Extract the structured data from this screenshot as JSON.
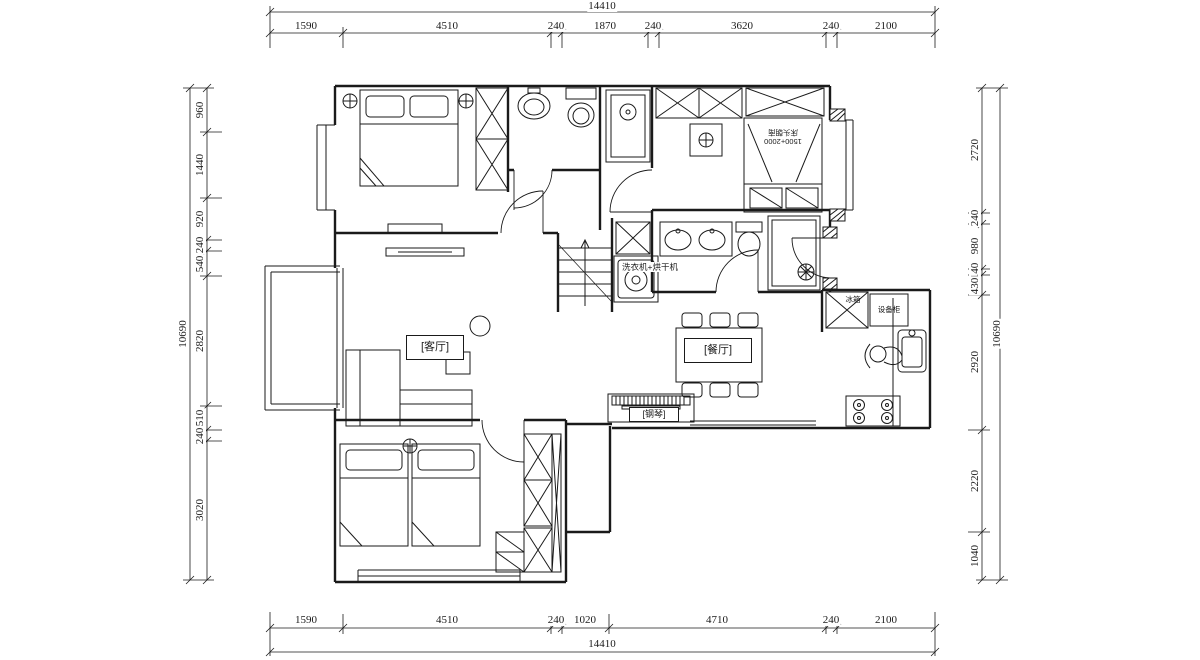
{
  "labels": {
    "living_room": "[客厅]",
    "dining_room": "[餐厅]",
    "piano": "[钢琴]",
    "equipment_cabinet": "设备柜",
    "fridge": "冰箱",
    "washer_dryer": "洗衣机+烘干机",
    "bed_note_size": "1500+2000",
    "bed_note_text": "床头朝南"
  },
  "dimensions": {
    "top": {
      "total": "14410",
      "segments": [
        "1590",
        "4510",
        "240",
        "1870",
        "240",
        "3620",
        "240",
        "2100"
      ]
    },
    "bottom": {
      "total": "14410",
      "segments": [
        "1590",
        "4510",
        "240",
        "1020",
        "4710",
        "240",
        "2100"
      ]
    },
    "left": {
      "total": "10690",
      "segments": [
        "960",
        "1440",
        "920",
        "240",
        "540",
        "2820",
        "510",
        "240",
        "3020"
      ]
    },
    "right": {
      "total": "10690",
      "segments": [
        "2720",
        "240",
        "980",
        "140",
        "430",
        "2920",
        "2220",
        "1040"
      ]
    }
  },
  "colors": {
    "line": "#1a1a1a",
    "background": "#ffffff"
  }
}
